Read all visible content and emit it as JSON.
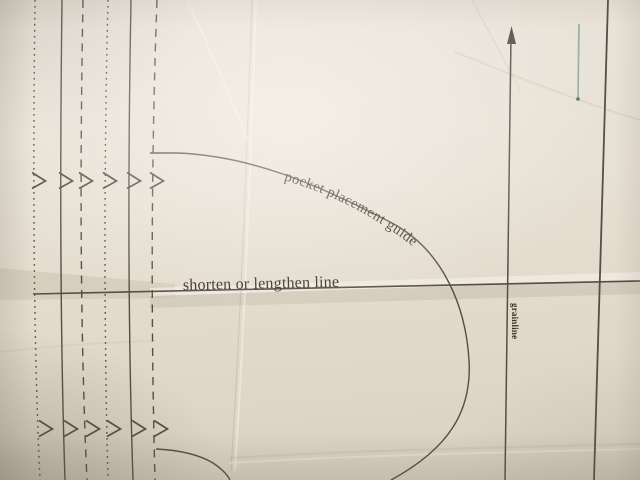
{
  "labels": {
    "pocket_guide": "pocket placement guide",
    "shorten_lengthen": "shorten or lengthen line",
    "grainline": "grainline"
  },
  "colors": {
    "paper": "#e7e0d4",
    "fold_band": "#c9bfae",
    "fold_highlight": "#f4efe6",
    "ink": "#554e45",
    "text_ink": "#3a332b",
    "teal": "#92b1a2",
    "teal_tip": "#57705f"
  },
  "pattern": {
    "notch_marker": "chevron-right-icon",
    "vertical_lines": [
      {
        "name": "pattern-line-dotted-1",
        "style": "dotted",
        "x_top": 35,
        "x_mid": 33,
        "x_bottom": 40,
        "notches": [
          {
            "x": 32,
            "y": 181
          },
          {
            "x": 39,
            "y": 429
          }
        ]
      },
      {
        "name": "pattern-line-solid-2",
        "style": "solid",
        "x_top": 62,
        "x_mid": 60,
        "x_bottom": 65,
        "notches": [
          {
            "x": 59,
            "y": 181
          },
          {
            "x": 64,
            "y": 429
          }
        ]
      },
      {
        "name": "pattern-line-dashed-3",
        "style": "dashed",
        "x_top": 83,
        "x_mid": 80,
        "x_bottom": 87,
        "notches": [
          {
            "x": 79,
            "y": 181
          },
          {
            "x": 86,
            "y": 429
          }
        ]
      },
      {
        "name": "pattern-line-dotted-4",
        "style": "dotted",
        "x_top": 108,
        "x_mid": 104,
        "x_bottom": 108,
        "notches": [
          {
            "x": 103,
            "y": 181
          },
          {
            "x": 107,
            "y": 429
          }
        ]
      },
      {
        "name": "pattern-line-solid-5",
        "style": "solid",
        "x_top": 131,
        "x_mid": 128,
        "x_bottom": 133,
        "notches": [
          {
            "x": 127,
            "y": 181
          },
          {
            "x": 132,
            "y": 429
          }
        ]
      },
      {
        "name": "pattern-line-dashed-6",
        "style": "dashed",
        "x_top": 157,
        "x_mid": 151,
        "x_bottom": 155,
        "notches": [
          {
            "x": 150,
            "y": 181
          },
          {
            "x": 154,
            "y": 429
          }
        ]
      }
    ]
  }
}
